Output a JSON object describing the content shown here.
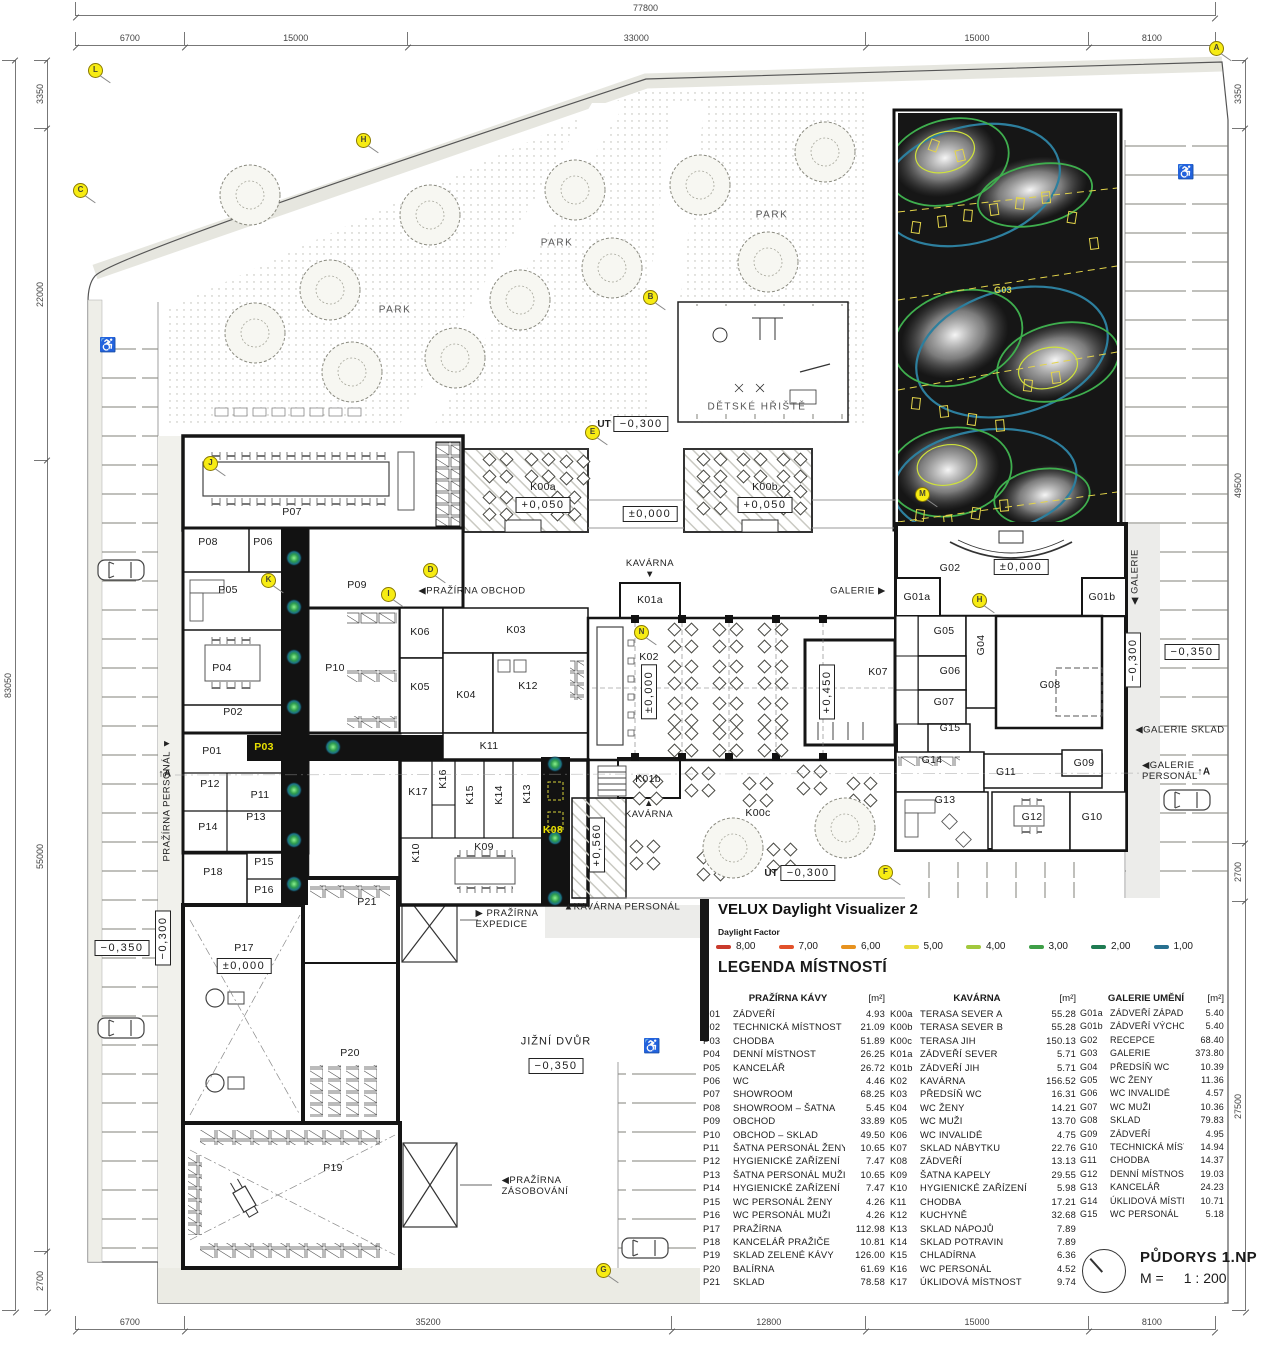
{
  "velux": {
    "title": "VELUX Daylight Visualizer 2",
    "factor_label": "Daylight Factor",
    "scale": [
      {
        "value": "8,00",
        "color": "#c93a2c"
      },
      {
        "value": "7,00",
        "color": "#e2512a"
      },
      {
        "value": "6,00",
        "color": "#e7921f"
      },
      {
        "value": "5,00",
        "color": "#e9da3b"
      },
      {
        "value": "4,00",
        "color": "#a2c83d"
      },
      {
        "value": "3,00",
        "color": "#3f9f47"
      },
      {
        "value": "2,00",
        "color": "#1e7b52"
      },
      {
        "value": "1,00",
        "color": "#27708f"
      }
    ]
  },
  "legend": {
    "heading": "LEGENDA MÍSTNOSTÍ",
    "col1": {
      "header": "PRAŽÍRNA KÁVY",
      "unit": "[m²]",
      "rows": [
        {
          "code": "P01",
          "name": "ZÁDVEŘÍ",
          "area": "4.93"
        },
        {
          "code": "P02",
          "name": "TECHNICKÁ MÍSTNOST",
          "area": "21.09"
        },
        {
          "code": "P03",
          "name": "CHODBA",
          "area": "51.89"
        },
        {
          "code": "P04",
          "name": "DENNÍ MÍSTNOST",
          "area": "26.25"
        },
        {
          "code": "P05",
          "name": "KANCELÁŘ",
          "area": "26.72"
        },
        {
          "code": "P06",
          "name": "WC",
          "area": "4.46"
        },
        {
          "code": "P07",
          "name": "SHOWROOM",
          "area": "68.25"
        },
        {
          "code": "P08",
          "name": "SHOWROOM – ŠATNA",
          "area": "5.45"
        },
        {
          "code": "P09",
          "name": "OBCHOD",
          "area": "33.89"
        },
        {
          "code": "P10",
          "name": "OBCHOD – SKLAD",
          "area": "49.50"
        },
        {
          "code": "P11",
          "name": "ŠATNA PERSONÁL ŽENY",
          "area": "10.65"
        },
        {
          "code": "P12",
          "name": "HYGIENICKÉ ZAŘÍZENÍ",
          "area": "7.47"
        },
        {
          "code": "P13",
          "name": "ŠATNA PERSONÁL MUŽI",
          "area": "10.65"
        },
        {
          "code": "P14",
          "name": "HYGIENICKÉ ZAŘÍZENÍ",
          "area": "7.47"
        },
        {
          "code": "P15",
          "name": "WC PERSONÁL ŽENY",
          "area": "4.26"
        },
        {
          "code": "P16",
          "name": "WC PERSONÁL MUŽI",
          "area": "4.26"
        },
        {
          "code": "P17",
          "name": "PRAŽÍRNA",
          "area": "112.98"
        },
        {
          "code": "P18",
          "name": "KANCELÁŘ PRAŽIČE",
          "area": "10.81"
        },
        {
          "code": "P19",
          "name": "SKLAD ZELENÉ KÁVY",
          "area": "126.00"
        },
        {
          "code": "P20",
          "name": "BALÍRNA",
          "area": "61.69"
        },
        {
          "code": "P21",
          "name": "SKLAD",
          "area": "78.58"
        }
      ]
    },
    "col2": {
      "header": "KAVÁRNA",
      "unit": "[m²]",
      "rows": [
        {
          "code": "K00a",
          "name": "TERASA SEVER A",
          "area": "55.28"
        },
        {
          "code": "K00b",
          "name": "TERASA SEVER B",
          "area": "55.28"
        },
        {
          "code": "K00c",
          "name": "TERASA JIH",
          "area": "150.13"
        },
        {
          "code": "K01a",
          "name": "ZÁDVEŘÍ SEVER",
          "area": "5.71"
        },
        {
          "code": "K01b",
          "name": "ZÁDVEŘÍ JIH",
          "area": "5.71"
        },
        {
          "code": "K02",
          "name": "KAVÁRNA",
          "area": "156.52"
        },
        {
          "code": "K03",
          "name": "PŘEDSÍŇ WC",
          "area": "16.31"
        },
        {
          "code": "K04",
          "name": "WC ŽENY",
          "area": "14.21"
        },
        {
          "code": "K05",
          "name": "WC MUŽI",
          "area": "13.70"
        },
        {
          "code": "K06",
          "name": "WC INVALIDÉ",
          "area": "4.75"
        },
        {
          "code": "K07",
          "name": "SKLAD NÁBYTKU",
          "area": "22.76"
        },
        {
          "code": "K08",
          "name": "ZÁDVEŘÍ",
          "area": "13.13"
        },
        {
          "code": "K09",
          "name": "ŠATNA KAPELY",
          "area": "29.55"
        },
        {
          "code": "K10",
          "name": "HYGIENICKÉ ZAŘÍZENÍ",
          "area": "5.98"
        },
        {
          "code": "K11",
          "name": "CHODBA",
          "area": "17.21"
        },
        {
          "code": "K12",
          "name": "KUCHYNĚ",
          "area": "32.68"
        },
        {
          "code": "K13",
          "name": "SKLAD NÁPOJŮ",
          "area": "7.89"
        },
        {
          "code": "K14",
          "name": "SKLAD POTRAVIN",
          "area": "7.89"
        },
        {
          "code": "K15",
          "name": "CHLADÍRNA",
          "area": "6.36"
        },
        {
          "code": "K16",
          "name": "WC PERSONÁL",
          "area": "4.52"
        },
        {
          "code": "K17",
          "name": "ÚKLIDOVÁ MÍSTNOST",
          "area": "9.74"
        }
      ]
    },
    "col3": {
      "header": "GALERIE UMĚNÍ",
      "unit": "[m²]",
      "rows": [
        {
          "code": "G01a",
          "name": "ZÁDVEŘÍ ZÁPAD",
          "area": "5.40"
        },
        {
          "code": "G01b",
          "name": "ZÁDVEŘÍ VÝCHOD",
          "area": "5.40"
        },
        {
          "code": "G02",
          "name": "RECEPCE",
          "area": "68.40"
        },
        {
          "code": "G03",
          "name": "GALERIE",
          "area": "373.80"
        },
        {
          "code": "G04",
          "name": "PŘEDSÍŇ WC",
          "area": "10.39"
        },
        {
          "code": "G05",
          "name": "WC ŽENY",
          "area": "11.36"
        },
        {
          "code": "G06",
          "name": "WC INVALIDÉ",
          "area": "4.57"
        },
        {
          "code": "G07",
          "name": "WC MUŽI",
          "area": "10.36"
        },
        {
          "code": "G08",
          "name": "SKLAD",
          "area": "79.83"
        },
        {
          "code": "G09",
          "name": "ZÁDVEŘÍ",
          "area": "4.95"
        },
        {
          "code": "G10",
          "name": "TECHNICKÁ MÍSTNOST",
          "area": "14.94"
        },
        {
          "code": "G11",
          "name": "CHODBA",
          "area": "14.37"
        },
        {
          "code": "G12",
          "name": "DENNÍ MÍSTNOST",
          "area": "19.03"
        },
        {
          "code": "G13",
          "name": "KANCELÁŘ",
          "area": "24.23"
        },
        {
          "code": "G14",
          "name": "ÚKLIDOVÁ MÍSTNOST",
          "area": "10.71"
        },
        {
          "code": "G15",
          "name": "WC PERSONÁL",
          "area": "5.18"
        }
      ]
    }
  },
  "title_block": {
    "drawing_title": "PŮDORYS 1.NP",
    "scale_label": "M =",
    "scale_value": "1 : 200"
  },
  "dimensions": {
    "top_total": "77800",
    "left_total": "83050",
    "top": [
      {
        "label": "6700",
        "flex": 6700
      },
      {
        "label": "15000",
        "flex": 15000
      },
      {
        "label": "33000",
        "flex": 33000
      },
      {
        "label": "15000",
        "flex": 15000
      },
      {
        "label": "8100",
        "flex": 8100
      }
    ],
    "bottom": [
      {
        "label": "6700",
        "flex": 6700
      },
      {
        "label": "35200",
        "flex": 35200
      },
      {
        "label": "12800",
        "flex": 12800
      },
      {
        "label": "15000",
        "flex": 15000
      },
      {
        "label": "8100",
        "flex": 8100
      }
    ],
    "left": [
      {
        "label": "3350",
        "flex": 3350
      },
      {
        "label": "22000",
        "flex": 22000
      },
      {
        "label": "55000",
        "flex": 55000
      },
      {
        "label": "2700",
        "flex": 2700
      }
    ],
    "right": [
      {
        "label": "3350",
        "flex": 3350
      },
      {
        "label": "49500",
        "flex": 49500
      },
      {
        "label": "2700",
        "flex": 2700
      },
      {
        "label": "27500",
        "flex": 27500
      }
    ]
  },
  "plan": {
    "rooms": [
      {
        "label": "P01",
        "x": 212,
        "y": 751
      },
      {
        "label": "P02",
        "x": 233,
        "y": 712
      },
      {
        "label": "P03",
        "x": 264,
        "y": 747,
        "cls": "y"
      },
      {
        "label": "P04",
        "x": 222,
        "y": 668
      },
      {
        "label": "P05",
        "x": 228,
        "y": 590
      },
      {
        "label": "P06",
        "x": 263,
        "y": 542
      },
      {
        "label": "P07",
        "x": 292,
        "y": 512
      },
      {
        "label": "P08",
        "x": 208,
        "y": 542
      },
      {
        "label": "P09",
        "x": 357,
        "y": 585
      },
      {
        "label": "P10",
        "x": 335,
        "y": 668
      },
      {
        "label": "P11",
        "x": 260,
        "y": 795
      },
      {
        "label": "P12",
        "x": 210,
        "y": 784
      },
      {
        "label": "P13",
        "x": 256,
        "y": 817
      },
      {
        "label": "P14",
        "x": 208,
        "y": 827
      },
      {
        "label": "P15",
        "x": 264,
        "y": 862
      },
      {
        "label": "P16",
        "x": 264,
        "y": 890
      },
      {
        "label": "P17",
        "x": 244,
        "y": 948
      },
      {
        "label": "P18",
        "x": 213,
        "y": 872
      },
      {
        "label": "P19",
        "x": 333,
        "y": 1168
      },
      {
        "label": "P20",
        "x": 350,
        "y": 1053
      },
      {
        "label": "P21",
        "x": 367,
        "y": 902
      },
      {
        "label": "K00a",
        "x": 543,
        "y": 487
      },
      {
        "label": "K00b",
        "x": 765,
        "y": 487
      },
      {
        "label": "K00c",
        "x": 758,
        "y": 813
      },
      {
        "label": "K01a",
        "x": 650,
        "y": 600
      },
      {
        "label": "K01b",
        "x": 648,
        "y": 779
      },
      {
        "label": "K02",
        "x": 649,
        "y": 657
      },
      {
        "label": "K03",
        "x": 516,
        "y": 630
      },
      {
        "label": "K04",
        "x": 466,
        "y": 695
      },
      {
        "label": "K05",
        "x": 420,
        "y": 687
      },
      {
        "label": "K06",
        "x": 420,
        "y": 632
      },
      {
        "label": "K07",
        "x": 878,
        "y": 672
      },
      {
        "label": "K08",
        "x": 553,
        "y": 830,
        "cls": "y"
      },
      {
        "label": "K09",
        "x": 484,
        "y": 847
      },
      {
        "label": "K10",
        "x": 416,
        "y": 853,
        "cls": "v"
      },
      {
        "label": "K11",
        "x": 489,
        "y": 746
      },
      {
        "label": "K12",
        "x": 528,
        "y": 686
      },
      {
        "label": "K13",
        "x": 527,
        "y": 794,
        "cls": "v"
      },
      {
        "label": "K14",
        "x": 499,
        "y": 795,
        "cls": "v"
      },
      {
        "label": "K15",
        "x": 470,
        "y": 795,
        "cls": "v"
      },
      {
        "label": "K16",
        "x": 443,
        "y": 779,
        "cls": "v"
      },
      {
        "label": "K17",
        "x": 418,
        "y": 792
      },
      {
        "label": "G01a",
        "x": 917,
        "y": 597
      },
      {
        "label": "G01b",
        "x": 1102,
        "y": 597
      },
      {
        "label": "G02",
        "x": 950,
        "y": 568
      },
      {
        "label": "G03",
        "x": 1003,
        "y": 290,
        "cls": "g03"
      },
      {
        "label": "G04",
        "x": 981,
        "y": 645,
        "cls": "v"
      },
      {
        "label": "G05",
        "x": 944,
        "y": 631
      },
      {
        "label": "G06",
        "x": 950,
        "y": 671
      },
      {
        "label": "G07",
        "x": 944,
        "y": 702
      },
      {
        "label": "G08",
        "x": 1050,
        "y": 685
      },
      {
        "label": "G09",
        "x": 1084,
        "y": 763
      },
      {
        "label": "G10",
        "x": 1092,
        "y": 817
      },
      {
        "label": "G11",
        "x": 1006,
        "y": 772
      },
      {
        "label": "G12",
        "x": 1032,
        "y": 817
      },
      {
        "label": "G13",
        "x": 945,
        "y": 800
      },
      {
        "label": "G14",
        "x": 932,
        "y": 760
      },
      {
        "label": "G15",
        "x": 950,
        "y": 728
      }
    ],
    "elevations": [
      {
        "text": "−0,300",
        "pre": "UT",
        "x": 633,
        "y": 424
      },
      {
        "text": "±0,000",
        "x": 650,
        "y": 514
      },
      {
        "text": "+0,050",
        "x": 543,
        "y": 505
      },
      {
        "text": "+0,050",
        "x": 765,
        "y": 505
      },
      {
        "text": "±0,000",
        "x": 649,
        "y": 692,
        "cls": "v"
      },
      {
        "text": "+0,450",
        "x": 827,
        "y": 692,
        "cls": "v"
      },
      {
        "text": "+0,560",
        "x": 597,
        "y": 845,
        "cls": "v"
      },
      {
        "text": "±0,000",
        "x": 1021,
        "y": 567
      },
      {
        "text": "−0,300",
        "x": 1133,
        "y": 660,
        "cls": "v"
      },
      {
        "text": "−0,350",
        "x": 1192,
        "y": 652
      },
      {
        "text": "−0,300",
        "x": 163,
        "y": 938,
        "cls": "v"
      },
      {
        "text": "−0,350",
        "x": 122,
        "y": 948
      },
      {
        "text": "±0,000",
        "x": 244,
        "y": 966
      },
      {
        "text": "−0,350",
        "x": 556,
        "y": 1066
      },
      {
        "text": "−0,300",
        "pre": "UT",
        "x": 800,
        "y": 873
      }
    ],
    "annotations": [
      {
        "text": "PARK",
        "x": 395,
        "y": 310,
        "cls": "park"
      },
      {
        "text": "PARK",
        "x": 557,
        "y": 243,
        "cls": "park"
      },
      {
        "text": "PARK",
        "x": 772,
        "y": 215,
        "cls": "park"
      },
      {
        "text": "DĚTSKÉ HŘIŠTĚ",
        "x": 757,
        "y": 407,
        "cls": "park"
      },
      {
        "text": "KAVÁRNA\n▼",
        "x": 650,
        "y": 570,
        "cls": "c"
      },
      {
        "text": "▲\nKAVÁRNA",
        "x": 649,
        "y": 810,
        "cls": "c"
      },
      {
        "text": "GALERIE ▶",
        "x": 858,
        "y": 592
      },
      {
        "text": "◀PRAŽÍRNA OBCHOD",
        "x": 472,
        "y": 592
      },
      {
        "text": "▶ PRAŽÍRNA\n   EXPEDICE",
        "x": 507,
        "y": 920
      },
      {
        "text": "◀PRAŽÍRNA\n  ZÁSOBOVÁNÍ",
        "x": 535,
        "y": 1187
      },
      {
        "text": "▲KAVÁRNA  PERSONÁL",
        "x": 622,
        "y": 908
      },
      {
        "text": "◀GALERIE SKLAD",
        "x": 1180,
        "y": 731
      },
      {
        "text": "◀GALERIE PERSONÁL",
        "x": 1188,
        "y": 772
      },
      {
        "text": "PRAŽÍRNA  PERSONÁL ▼",
        "x": 168,
        "y": 800,
        "cls": "v"
      },
      {
        "text": "◀ GALERIE",
        "x": 1136,
        "y": 577,
        "cls": "v"
      },
      {
        "text": "JIŽNÍ DVŮR",
        "x": 556,
        "y": 1042,
        "cls": "big"
      },
      {
        "text": "↑A",
        "x": 165,
        "y": 774,
        "cls": "sec"
      },
      {
        "text": "↑A",
        "x": 1204,
        "y": 772,
        "cls": "sec"
      }
    ],
    "markers": [
      {
        "letter": "A",
        "x": 1216,
        "y": 48
      },
      {
        "letter": "L",
        "x": 95,
        "y": 70
      },
      {
        "letter": "C",
        "x": 80,
        "y": 190
      },
      {
        "letter": "H",
        "x": 363,
        "y": 140
      },
      {
        "letter": "B",
        "x": 650,
        "y": 297
      },
      {
        "letter": "E",
        "x": 592,
        "y": 432
      },
      {
        "letter": "J",
        "x": 210,
        "y": 463
      },
      {
        "letter": "D",
        "x": 430,
        "y": 570
      },
      {
        "letter": "K",
        "x": 268,
        "y": 580
      },
      {
        "letter": "I",
        "x": 388,
        "y": 594
      },
      {
        "letter": "M",
        "x": 922,
        "y": 494
      },
      {
        "letter": "N",
        "x": 641,
        "y": 632
      },
      {
        "letter": "H",
        "x": 979,
        "y": 600
      },
      {
        "letter": "F",
        "x": 885,
        "y": 872
      },
      {
        "letter": "G",
        "x": 603,
        "y": 1270
      }
    ]
  }
}
